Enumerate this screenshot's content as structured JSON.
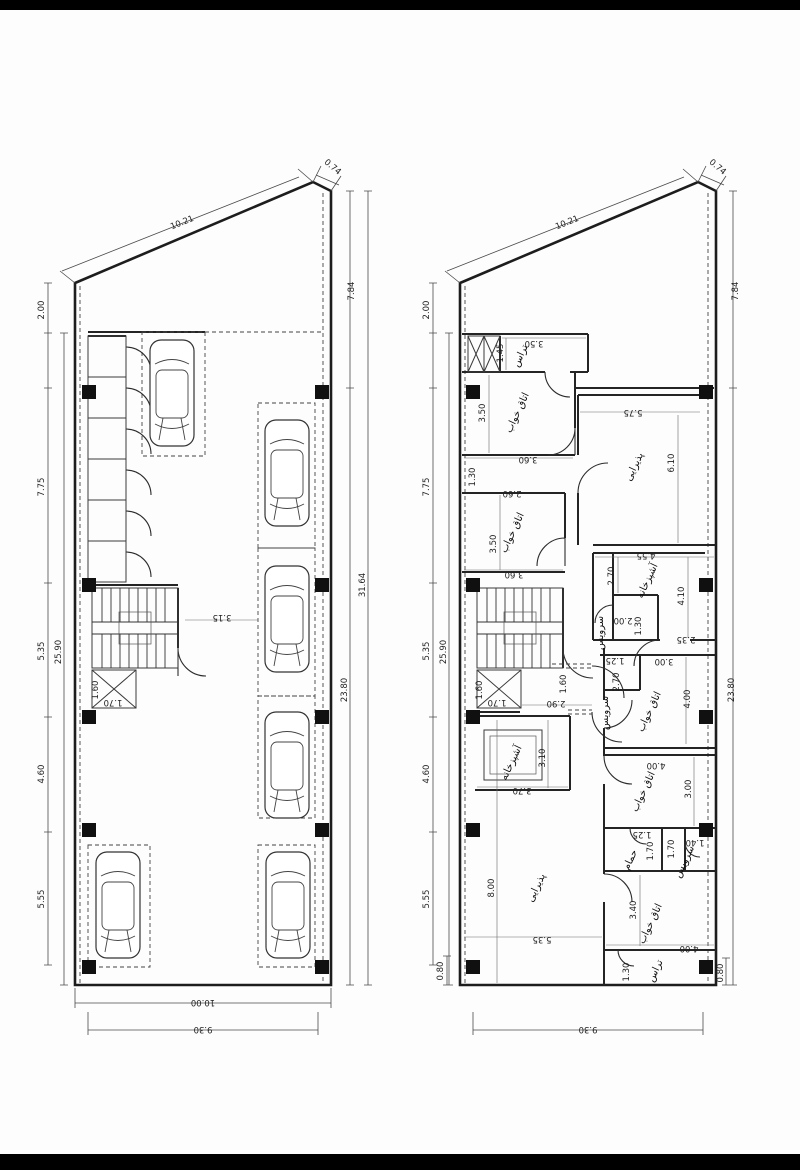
{
  "page": {
    "top_bar_color": "#000000",
    "bottom_bar_color": "#000000",
    "paper_color": "#fdfdfd"
  },
  "plans": {
    "left": {
      "title_semantic": "parking-floor-plan",
      "columns": [
        [
          82,
          385
        ],
        [
          82,
          578
        ],
        [
          82,
          710
        ],
        [
          82,
          823
        ],
        [
          82,
          960
        ],
        [
          315,
          385
        ],
        [
          315,
          578
        ],
        [
          315,
          710
        ],
        [
          315,
          823
        ],
        [
          315,
          960
        ]
      ],
      "stalls": [
        [
          142,
          332,
          63,
          124
        ],
        [
          258,
          403,
          57,
          145
        ],
        [
          258,
          548,
          57,
          148
        ],
        [
          258,
          696,
          57,
          122
        ],
        [
          88,
          845,
          62,
          122
        ],
        [
          258,
          845,
          57,
          122
        ]
      ],
      "cars": [
        [
          150,
          340
        ],
        [
          265,
          420
        ],
        [
          265,
          566
        ],
        [
          265,
          712
        ],
        [
          96,
          852
        ],
        [
          266,
          852
        ]
      ],
      "storage": {
        "x": 88,
        "y0": 336,
        "w": 38,
        "h": 41,
        "count": 6
      },
      "stairs": {
        "x": 92,
        "y": 588,
        "w": 86,
        "h": 80
      },
      "elevator": {
        "x": 92,
        "y": 670,
        "w": 44,
        "h": 38
      },
      "labels": [
        {
          "text": "10.21",
          "x": 183,
          "y": 225,
          "rot": -22,
          "kind": "dim"
        },
        {
          "text": "0.74",
          "x": 331,
          "y": 169,
          "rot": 40,
          "kind": "dim"
        },
        {
          "text": "2.00",
          "x": 44,
          "y": 310,
          "rot": -90,
          "kind": "dim"
        },
        {
          "text": "7.75",
          "x": 44,
          "y": 487,
          "rot": -90,
          "kind": "dim"
        },
        {
          "text": "5.35",
          "x": 44,
          "y": 651,
          "rot": -90,
          "kind": "dim"
        },
        {
          "text": "4.60",
          "x": 44,
          "y": 774,
          "rot": -90,
          "kind": "dim"
        },
        {
          "text": "5.55",
          "x": 44,
          "y": 899,
          "rot": -90,
          "kind": "dim"
        },
        {
          "text": "25.90",
          "x": 61,
          "y": 652,
          "rot": -90,
          "kind": "dim"
        },
        {
          "text": "7.84",
          "x": 354,
          "y": 291,
          "rot": -90,
          "kind": "dim"
        },
        {
          "text": "23.80",
          "x": 347,
          "y": 690,
          "rot": -90,
          "kind": "dim"
        },
        {
          "text": "31.64",
          "x": 365,
          "y": 585,
          "rot": -90,
          "kind": "dim"
        },
        {
          "text": "3.15",
          "x": 222,
          "y": 615,
          "rot": 180,
          "kind": "dim"
        },
        {
          "text": "1.60",
          "x": 98,
          "y": 690,
          "rot": -90,
          "kind": "dim"
        },
        {
          "text": "1.70",
          "x": 113,
          "y": 700,
          "rot": 180,
          "kind": "dim"
        },
        {
          "text": "10.00",
          "x": 203,
          "y": 1000,
          "rot": 180,
          "kind": "dim"
        },
        {
          "text": "9.30",
          "x": 203,
          "y": 1027,
          "rot": 180,
          "kind": "dim"
        }
      ]
    },
    "right": {
      "title_semantic": "residential-floor-plan",
      "columns": [
        [
          466,
          385
        ],
        [
          466,
          578
        ],
        [
          466,
          710
        ],
        [
          466,
          823
        ],
        [
          466,
          960
        ],
        [
          699,
          385
        ],
        [
          699,
          578
        ],
        [
          699,
          710
        ],
        [
          699,
          823
        ],
        [
          699,
          960
        ]
      ],
      "stairs": {
        "x": 477,
        "y": 588,
        "w": 86,
        "h": 80
      },
      "elevator": {
        "x": 477,
        "y": 670,
        "w": 44,
        "h": 38
      },
      "shaft": {
        "x": 468,
        "y": 336,
        "w": 32,
        "h": 36
      },
      "labels": [
        {
          "text": "10.21",
          "x": 568,
          "y": 225,
          "rot": -22,
          "kind": "dim"
        },
        {
          "text": "0.74",
          "x": 716,
          "y": 169,
          "rot": 40,
          "kind": "dim"
        },
        {
          "text": "2.00",
          "x": 429,
          "y": 310,
          "rot": -90,
          "kind": "dim"
        },
        {
          "text": "7.75",
          "x": 429,
          "y": 487,
          "rot": -90,
          "kind": "dim"
        },
        {
          "text": "5.35",
          "x": 429,
          "y": 651,
          "rot": -90,
          "kind": "dim"
        },
        {
          "text": "4.60",
          "x": 429,
          "y": 774,
          "rot": -90,
          "kind": "dim"
        },
        {
          "text": "5.55",
          "x": 429,
          "y": 899,
          "rot": -90,
          "kind": "dim"
        },
        {
          "text": "25.90",
          "x": 446,
          "y": 652,
          "rot": -90,
          "kind": "dim"
        },
        {
          "text": "7.84",
          "x": 738,
          "y": 291,
          "rot": -90,
          "kind": "dim"
        },
        {
          "text": "23.80",
          "x": 734,
          "y": 690,
          "rot": -90,
          "kind": "dim"
        },
        {
          "text": "9.30",
          "x": 588,
          "y": 1027,
          "rot": 180,
          "kind": "dim"
        },
        {
          "text": "0.80",
          "x": 443,
          "y": 971,
          "rot": -90,
          "kind": "dim"
        },
        {
          "text": "0.80",
          "x": 723,
          "y": 973,
          "rot": -90,
          "kind": "dim"
        },
        {
          "text": "3.50",
          "x": 534,
          "y": 341,
          "rot": 180,
          "kind": "dim"
        },
        {
          "text": "1.45",
          "x": 503,
          "y": 353,
          "rot": -90,
          "kind": "dim"
        },
        {
          "text": "3.50",
          "x": 485,
          "y": 413,
          "rot": -90,
          "kind": "dim"
        },
        {
          "text": "3.60",
          "x": 528,
          "y": 457,
          "rot": 180,
          "kind": "dim"
        },
        {
          "text": "1.30",
          "x": 475,
          "y": 477,
          "rot": -90,
          "kind": "dim"
        },
        {
          "text": "2.60",
          "x": 512,
          "y": 491,
          "rot": 180,
          "kind": "dim"
        },
        {
          "text": "5.75",
          "x": 633,
          "y": 410,
          "rot": 180,
          "kind": "dim"
        },
        {
          "text": "6.10",
          "x": 674,
          "y": 463,
          "rot": -90,
          "kind": "dim"
        },
        {
          "text": "3.50",
          "x": 496,
          "y": 544,
          "rot": -90,
          "kind": "dim"
        },
        {
          "text": "3.60",
          "x": 514,
          "y": 572,
          "rot": 180,
          "kind": "dim"
        },
        {
          "text": "4.55",
          "x": 646,
          "y": 553,
          "rot": 180,
          "kind": "dim"
        },
        {
          "text": "2.70",
          "x": 614,
          "y": 576,
          "rot": -90,
          "kind": "dim"
        },
        {
          "text": "4.10",
          "x": 684,
          "y": 596,
          "rot": -90,
          "kind": "dim"
        },
        {
          "text": "2.00",
          "x": 623,
          "y": 618,
          "rot": 180,
          "kind": "dim"
        },
        {
          "text": "1.30",
          "x": 641,
          "y": 626,
          "rot": -90,
          "kind": "dim"
        },
        {
          "text": "2.35",
          "x": 686,
          "y": 637,
          "rot": 180,
          "kind": "dim"
        },
        {
          "text": "1.60",
          "x": 482,
          "y": 690,
          "rot": -90,
          "kind": "dim"
        },
        {
          "text": "1.70",
          "x": 497,
          "y": 700,
          "rot": 180,
          "kind": "dim"
        },
        {
          "text": "1.60",
          "x": 566,
          "y": 684,
          "rot": -90,
          "kind": "dim"
        },
        {
          "text": "2.90",
          "x": 556,
          "y": 701,
          "rot": 180,
          "kind": "dim"
        },
        {
          "text": "1.25",
          "x": 615,
          "y": 658,
          "rot": 180,
          "kind": "dim"
        },
        {
          "text": "2.70",
          "x": 619,
          "y": 682,
          "rot": -90,
          "kind": "dim"
        },
        {
          "text": "3.00",
          "x": 664,
          "y": 659,
          "rot": 180,
          "kind": "dim"
        },
        {
          "text": "4.00",
          "x": 690,
          "y": 699,
          "rot": -90,
          "kind": "dim"
        },
        {
          "text": "4.00",
          "x": 656,
          "y": 763,
          "rot": 180,
          "kind": "dim"
        },
        {
          "text": "3.00",
          "x": 691,
          "y": 789,
          "rot": -90,
          "kind": "dim"
        },
        {
          "text": "1.25",
          "x": 642,
          "y": 832,
          "rot": 180,
          "kind": "dim"
        },
        {
          "text": "1.70",
          "x": 653,
          "y": 851,
          "rot": -90,
          "kind": "dim"
        },
        {
          "text": "1.70",
          "x": 674,
          "y": 849,
          "rot": -90,
          "kind": "dim"
        },
        {
          "text": "1.40",
          "x": 695,
          "y": 840,
          "rot": 180,
          "kind": "dim"
        },
        {
          "text": "3.40",
          "x": 636,
          "y": 910,
          "rot": -90,
          "kind": "dim"
        },
        {
          "text": "4.00",
          "x": 689,
          "y": 946,
          "rot": 180,
          "kind": "dim"
        },
        {
          "text": "8.00",
          "x": 494,
          "y": 888,
          "rot": -90,
          "kind": "dim"
        },
        {
          "text": "5.35",
          "x": 542,
          "y": 937,
          "rot": 180,
          "kind": "dim"
        },
        {
          "text": "3.10",
          "x": 545,
          "y": 758,
          "rot": -90,
          "kind": "dim"
        },
        {
          "text": "3.70",
          "x": 522,
          "y": 788,
          "rot": 180,
          "kind": "dim"
        },
        {
          "text": "1.30",
          "x": 629,
          "y": 972,
          "rot": -90,
          "kind": "dim"
        },
        {
          "text": "تراس",
          "x": 523,
          "y": 357,
          "rot": -65,
          "kind": "room"
        },
        {
          "text": "اتاق خواب",
          "x": 520,
          "y": 414,
          "rot": -65,
          "kind": "room"
        },
        {
          "text": "پذیرایی",
          "x": 637,
          "y": 468,
          "rot": -65,
          "kind": "room"
        },
        {
          "text": "اتاق خواب",
          "x": 515,
          "y": 534,
          "rot": -65,
          "kind": "room"
        },
        {
          "text": "آشپزخانه",
          "x": 650,
          "y": 582,
          "rot": -65,
          "kind": "room"
        },
        {
          "text": "سرویس",
          "x": 603,
          "y": 633,
          "rot": -90,
          "kind": "room"
        },
        {
          "text": "سرویس",
          "x": 608,
          "y": 713,
          "rot": -90,
          "kind": "room"
        },
        {
          "text": "اتاق خواب",
          "x": 652,
          "y": 713,
          "rot": -65,
          "kind": "room"
        },
        {
          "text": "اتاق خواب",
          "x": 646,
          "y": 793,
          "rot": -65,
          "kind": "room"
        },
        {
          "text": "حمام",
          "x": 633,
          "y": 861,
          "rot": -65,
          "kind": "room"
        },
        {
          "text": "سرویس",
          "x": 687,
          "y": 863,
          "rot": -65,
          "kind": "room"
        },
        {
          "text": "آشپزخانه",
          "x": 514,
          "y": 764,
          "rot": -65,
          "kind": "room"
        },
        {
          "text": "اتاق خواب",
          "x": 653,
          "y": 925,
          "rot": -65,
          "kind": "room"
        },
        {
          "text": "پذیرایی",
          "x": 539,
          "y": 889,
          "rot": -65,
          "kind": "room"
        },
        {
          "text": "تراس",
          "x": 658,
          "y": 972,
          "rot": -65,
          "kind": "room"
        }
      ]
    }
  }
}
